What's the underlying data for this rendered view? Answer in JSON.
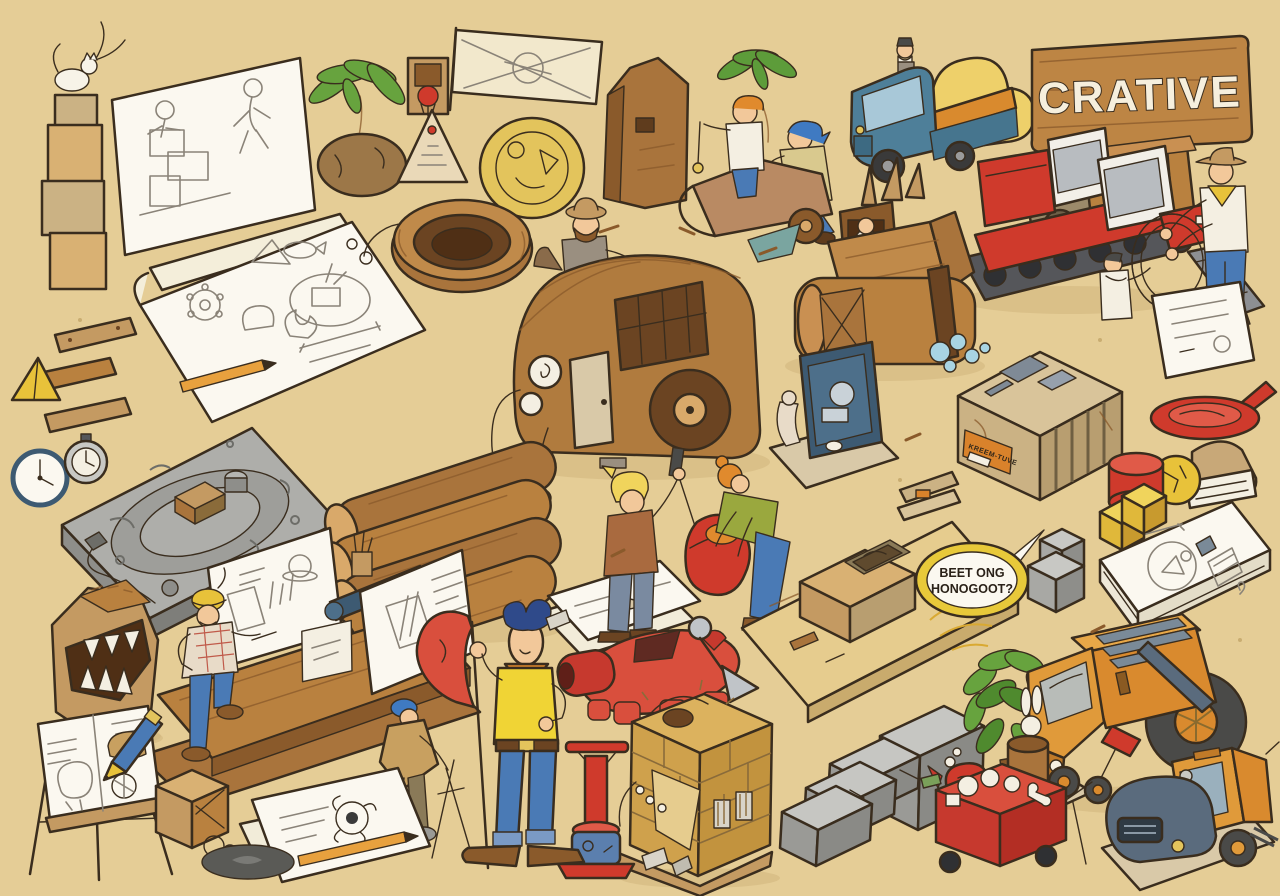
{
  "scene": {
    "description": "Hand-drawn isometric cartoon illustration: a sandy creative construction yard filled with cartoon characters, wooden vehicles, stone blocks, sketchbooks and tools",
    "background_color": "#e5cd96",
    "outline_color": "#3a2d1e"
  },
  "sign": {
    "text": "CRATIVE",
    "board_color": "#bd8544",
    "letter_color": "#f6efdd"
  },
  "speech_bubble": {
    "line1": "BEET ONG",
    "line2": "HONOGOOT?",
    "fill": "#fbf8f0",
    "ring_color": "#e8c93a"
  },
  "labels": {
    "crate_label": "KREEM-TUVE"
  },
  "palette": {
    "wood_mid": "#b9813f",
    "wood_dark": "#8a5a2b",
    "wood_light": "#d9a96a",
    "paper": "#fbf8f0",
    "stone_gray": "#aeaeaa",
    "red": "#cf3a2c",
    "truck_blue": "#4e7f99",
    "cargo_yellow": "#eed06a",
    "orange_truck": "#d98a2e",
    "jeans_blue": "#4a7ab5",
    "shirt_yellow": "#f0d435",
    "leaf_green": "#67a33e",
    "skin": "#f2c89a",
    "bubble_yellow": "#e8c93a"
  },
  "objects": [
    {
      "name": "stone-cat-totem",
      "description": "stacked tan stone blocks with a white cat on top"
    },
    {
      "name": "sketch-whiteboard",
      "description": "tilted white board with pencil sketches of a builder and a running figure"
    },
    {
      "name": "palm-tree-rock",
      "description": "small palm tree growing from a brown boulder"
    },
    {
      "name": "basketball-hoop",
      "description": "tiny wooden frame with red hoop"
    },
    {
      "name": "triangle-sign",
      "description": "cream triangle sketch board"
    },
    {
      "name": "banner-flag",
      "description": "cream banner on a pole with a sketched diagram"
    },
    {
      "name": "engraved-coin",
      "description": "large golden disc with carvings"
    },
    {
      "name": "wooden-monolith",
      "description": "tall brown wooden slab"
    },
    {
      "name": "wooden-rickshaw-riders",
      "description": "orange-haired rider with pendulum in wooden cart pushed by blue-haired man"
    },
    {
      "name": "blue-cargo-truck",
      "description": "blue cab truck loaded with yellow sacks, tiny old man on roof"
    },
    {
      "name": "crative-sign",
      "description": "wooden plank sign with white lettering"
    },
    {
      "name": "wooden-horse-trailer",
      "description": "slatted wooden trailer truck"
    },
    {
      "name": "red-snowcat",
      "description": "red tracked vehicle with two white cabs and boarding ramp"
    },
    {
      "name": "cowboy-with-lasso",
      "description": "cowboy in hat holding a stiff rope ring with small white-suited helper"
    },
    {
      "name": "paper-sheet-right",
      "description": "loose sketch sheet"
    },
    {
      "name": "open-sketchbook",
      "description": "big open sketchbook with doodles of gear, pyramid, fish, plant and dimensioned circle"
    },
    {
      "name": "wooden-planks",
      "description": "three small wooden boards"
    },
    {
      "name": "yellow-pyramid",
      "description": "small yellow pyramid"
    },
    {
      "name": "rope-tub",
      "description": "round wooden tub with vine rope"
    },
    {
      "name": "wooden-camper-van",
      "description": "rounded wooden camper with round headlights and big wheel"
    },
    {
      "name": "traveler-on-camper",
      "description": "bearded hat-wearing traveler leaning on camper roof"
    },
    {
      "name": "wooden-tank",
      "description": "log-built tank with robed driver, wooden spikes and water splashes"
    },
    {
      "name": "blueprint-machine",
      "description": "navy drafting panel contraption on tan base"
    },
    {
      "name": "slotted-stone-block",
      "description": "big tan block with slots, gray patches and orange label"
    },
    {
      "name": "red-pan",
      "description": "red disc pan with handle"
    },
    {
      "name": "flour-bag-dough",
      "description": "tan bag with white wrap and yellow dough ball"
    },
    {
      "name": "red-cylinder",
      "description": "small red cylinder"
    },
    {
      "name": "yellow-blocks",
      "description": "yellow iso cubes"
    },
    {
      "name": "sketch-pad-stack",
      "description": "thick white pad with face and grater doodles"
    },
    {
      "name": "gray-cubes",
      "description": "two gray stone cubes"
    },
    {
      "name": "engraved-stone-slab",
      "description": "gray slab engraved with concentric circles, blocks and cable"
    },
    {
      "name": "wall-clock",
      "description": "white wall clock"
    },
    {
      "name": "stopwatch",
      "description": "gray stopwatch"
    },
    {
      "name": "cardboard-monster",
      "description": "cardboard sculpture with toothy mouth"
    },
    {
      "name": "drafting-platform",
      "description": "wooden stage with white sketch boards, rolled blueprint and pencil cup"
    },
    {
      "name": "construction-worker",
      "description": "worker in yellow hard hat and plaid shirt"
    },
    {
      "name": "log-pile",
      "description": "four stacked timber logs"
    },
    {
      "name": "inventor-pair",
      "description": "blond man with tool and green-sweater helper bending over red sculpture"
    },
    {
      "name": "red-sculpture",
      "description": "red guitar-like piece with strap"
    },
    {
      "name": "sand-diorama",
      "description": "tan board diorama with brick block excavation and straw"
    },
    {
      "name": "speech-bubble",
      "description": "yellow-rimmed speech bubble"
    },
    {
      "name": "red-dog-sculpture",
      "description": "red lying animal sculpture"
    },
    {
      "name": "brick-fort-telescope",
      "description": "golden brick block with metal telescope spike"
    },
    {
      "name": "stone-staircase",
      "description": "gray stepped blocks"
    },
    {
      "name": "tripod-stool",
      "description": "three-legged wooden stool"
    },
    {
      "name": "red-hammer",
      "description": "red mallet leaning on steps"
    },
    {
      "name": "red-whistle",
      "description": "red kettle whistle"
    },
    {
      "name": "plunger-hydrant",
      "description": "red detonator plunger on blue drum base"
    },
    {
      "name": "cart-pusher-man",
      "description": "hunched man in cap pushing stick plow"
    },
    {
      "name": "cowboy-with-flag",
      "description": "tall lanky cowboy in yellow shirt holding red flag on pole"
    },
    {
      "name": "painting-easel",
      "description": "wooden easel with sketch board and giant blue pencil"
    },
    {
      "name": "sketch-papers-bottom",
      "description": "loose papers with dark flower sketch and pencil"
    },
    {
      "name": "rope-crate",
      "description": "small wooden crate with rope coil"
    },
    {
      "name": "tar-puddle",
      "description": "dark tar puddle"
    },
    {
      "name": "orange-armored-truck",
      "description": "orange truck with roof rails and huge rear wheel"
    },
    {
      "name": "street-sweeper",
      "description": "orange sweeper with blue-gray roller drum"
    },
    {
      "name": "green-bush",
      "description": "leafy green shrub"
    },
    {
      "name": "red-cart-figures",
      "description": "red cart holding white figurines with steaming rabbit pot"
    },
    {
      "name": "chalk-pieces",
      "description": "small white chalk fragments"
    }
  ]
}
